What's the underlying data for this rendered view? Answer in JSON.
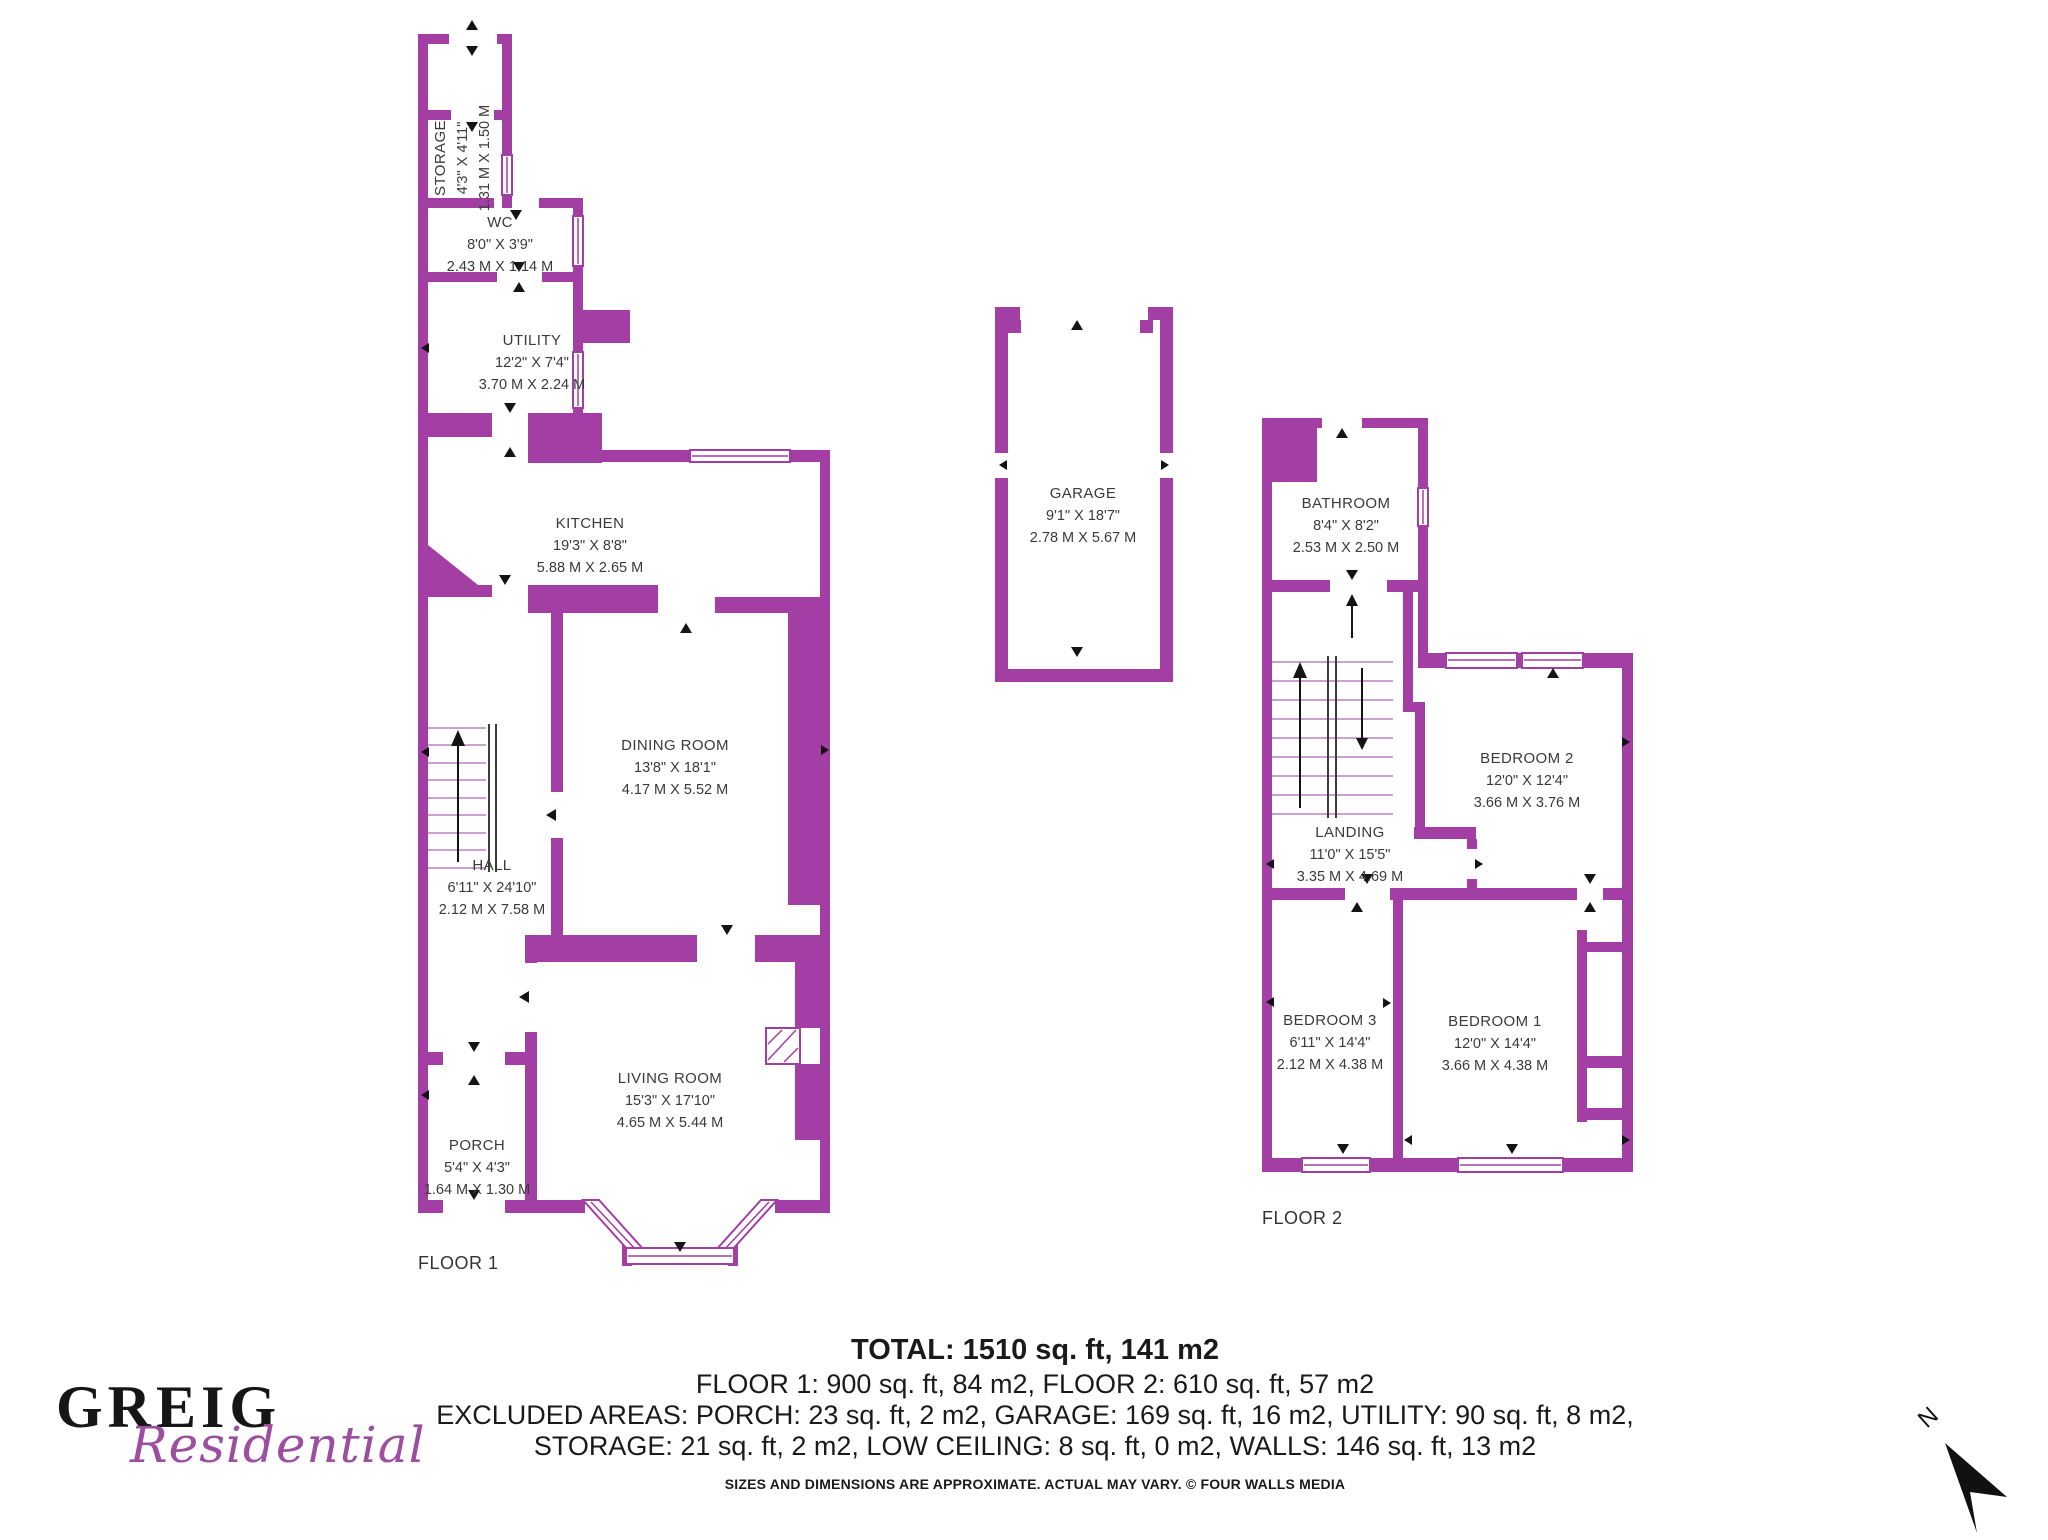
{
  "branding": {
    "brand_name": "GREIG",
    "brand_tagline": "Residential"
  },
  "compass": {
    "north_label": "N"
  },
  "floors": {
    "floor1_label": "FLOOR 1",
    "floor2_label": "FLOOR 2"
  },
  "rooms": {
    "storage": {
      "name": "STORAGE",
      "imperial": "4'3\" X 4'11\"",
      "metric": "1.31 M X 1.50 M"
    },
    "wc": {
      "name": "WC",
      "imperial": "8'0\" X 3'9\"",
      "metric": "2.43 M X 1.14 M"
    },
    "utility": {
      "name": "UTILITY",
      "imperial": "12'2\" X 7'4\"",
      "metric": "3.70 M X 2.24 M"
    },
    "kitchen": {
      "name": "KITCHEN",
      "imperial": "19'3\" X 8'8\"",
      "metric": "5.88 M X 2.65 M"
    },
    "dining": {
      "name": "DINING ROOM",
      "imperial": "13'8\" X 18'1\"",
      "metric": "4.17 M X 5.52 M"
    },
    "hall": {
      "name": "HALL",
      "imperial": "6'11\" X 24'10\"",
      "metric": "2.12 M X 7.58 M"
    },
    "living": {
      "name": "LIVING ROOM",
      "imperial": "15'3\" X 17'10\"",
      "metric": "4.65 M X 5.44 M"
    },
    "porch": {
      "name": "PORCH",
      "imperial": "5'4\" X 4'3\"",
      "metric": "1.64 M X 1.30 M"
    },
    "garage": {
      "name": "GARAGE",
      "imperial": "9'1\" X 18'7\"",
      "metric": "2.78 M X 5.67 M"
    },
    "bathroom": {
      "name": "BATHROOM",
      "imperial": "8'4\" X 8'2\"",
      "metric": "2.53 M X 2.50 M"
    },
    "landing": {
      "name": "LANDING",
      "imperial": "11'0\" X 15'5\"",
      "metric": "3.35 M X 4.69 M"
    },
    "bedroom2": {
      "name": "BEDROOM 2",
      "imperial": "12'0\" X 12'4\"",
      "metric": "3.66 M X 3.76 M"
    },
    "bedroom3": {
      "name": "BEDROOM 3",
      "imperial": "6'11\" X 14'4\"",
      "metric": "2.12 M X 4.38 M"
    },
    "bedroom1": {
      "name": "BEDROOM 1",
      "imperial": "12'0\" X 14'4\"",
      "metric": "3.66 M X 4.38 M"
    }
  },
  "summary": {
    "total": "TOTAL: 1510 sq. ft, 141 m2",
    "floors_line": "FLOOR 1: 900 sq. ft, 84 m2, FLOOR 2: 610 sq. ft, 57 m2",
    "excluded_1": "EXCLUDED AREAS: PORCH: 23 sq. ft, 2 m2, GARAGE: 169 sq. ft, 16 m2, UTILITY: 90 sq. ft, 8 m2,",
    "excluded_2": "STORAGE: 21 sq. ft, 2 m2, LOW CEILING: 8 sq. ft, 0 m2, WALLS: 146 sq. ft, 13 m2",
    "disclaimer": "SIZES AND DIMENSIONS ARE APPROXIMATE. ACTUAL MAY VARY. © FOUR WALLS MEDIA"
  },
  "colors": {
    "wall": "#A23EA4",
    "tagline": "#9C4FA0"
  }
}
